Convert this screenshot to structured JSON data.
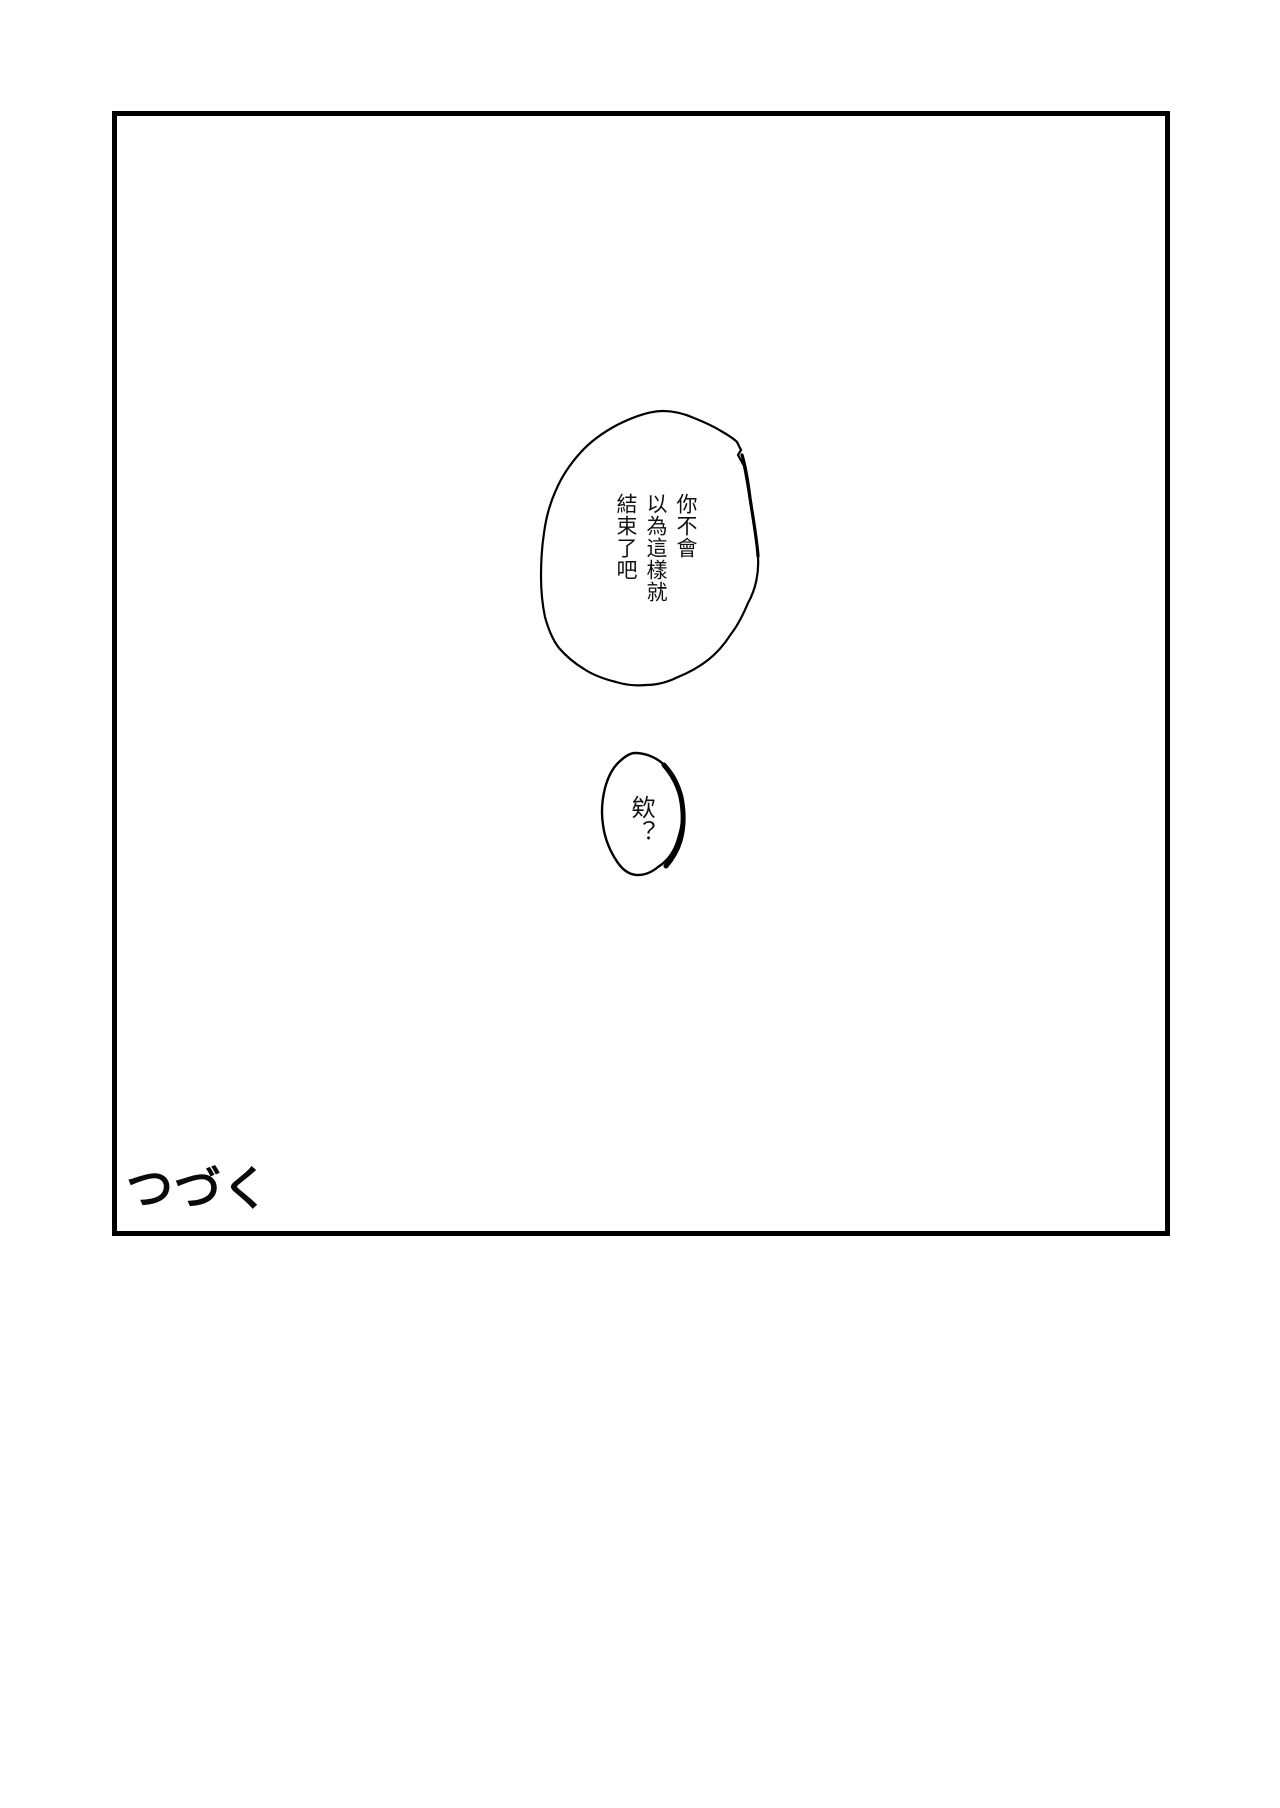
{
  "page": {
    "background_color": "#ffffff",
    "ink_color": "#000000",
    "description": "manga page with one large empty panel, two speech bubbles and a to-be-continued caption"
  },
  "panel": {
    "border_color": "#000000"
  },
  "speech_bubbles": [
    {
      "id": "large",
      "lines": [
        "你不會",
        "以為這樣就",
        "結束了吧"
      ]
    },
    {
      "id": "small",
      "lines": [
        "欸？"
      ]
    }
  ],
  "caption": {
    "to_be_continued": "つづく"
  }
}
